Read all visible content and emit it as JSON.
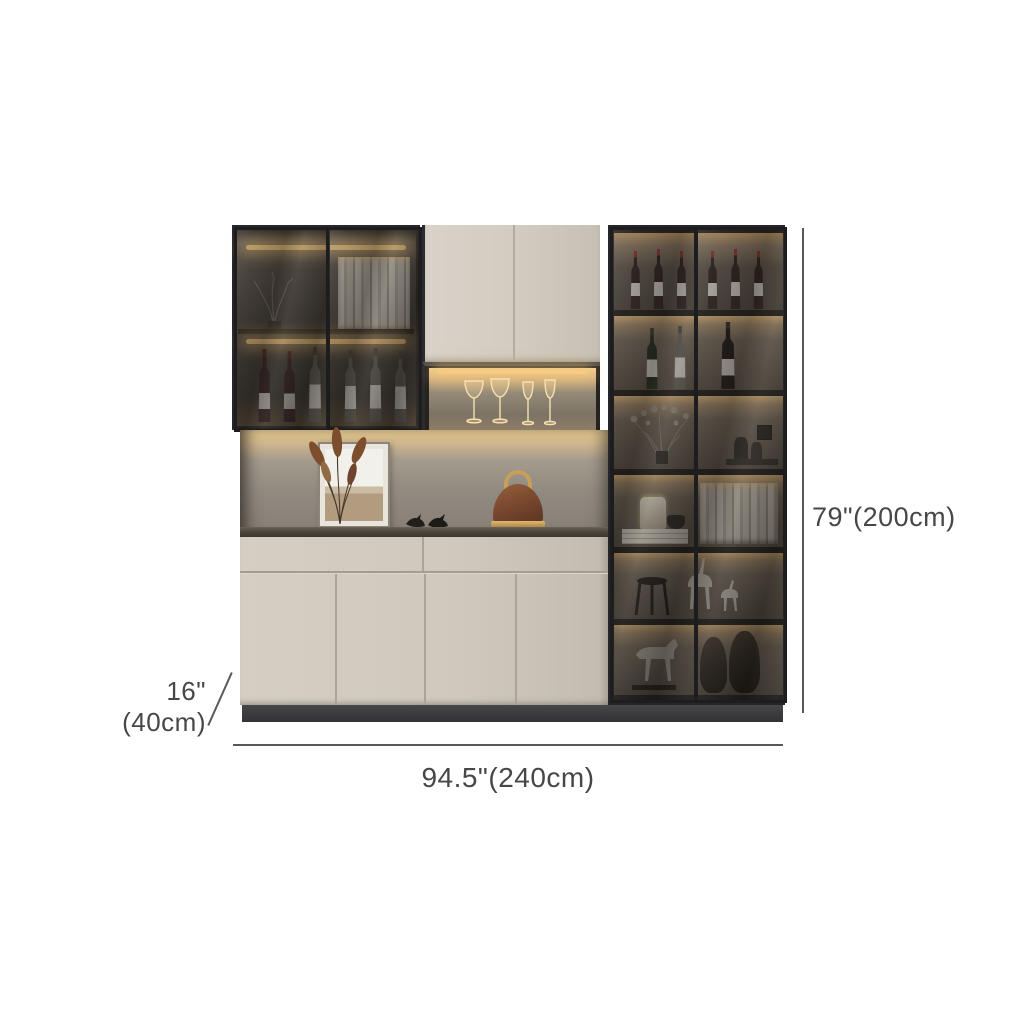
{
  "image": {
    "subject": "modern wine display cabinet with smoked glass doors and warm LED lighting",
    "background_color": "#ffffff"
  },
  "dimensions": {
    "height_label": "79\"(200cm)",
    "width_label": "94.5\"(240cm)",
    "depth_label": "16\"(40cm)"
  },
  "colors": {
    "door_cream": "#cfc9bd",
    "frame_dark": "#232327",
    "led_warm": "#f6ca80",
    "counter_top": "#4e463e",
    "plinth": "#3b3b3d",
    "dimension_line": "#58585c",
    "dimension_text": "#474747"
  },
  "cabinet": {
    "left_glass_cabinet_contents": [
      "decorative branch",
      "books",
      "wine bottles"
    ],
    "upper_middle_cabinet": "closed cream double doors",
    "lighted_niche_contents": [
      "wine glasses",
      "champagne flutes"
    ],
    "open_shelf_contents": [
      "framed artwork",
      "dried plant",
      "bird figurines",
      "brown handbag"
    ],
    "lower_cabinet": "cream drawers and four doors on dark plinth",
    "right_glass_cabinet_shelves": [
      "wine bottles",
      "champagne bottles",
      "dried flowers and jars",
      "candle and books",
      "deer figurines",
      "horse sculptures"
    ]
  }
}
